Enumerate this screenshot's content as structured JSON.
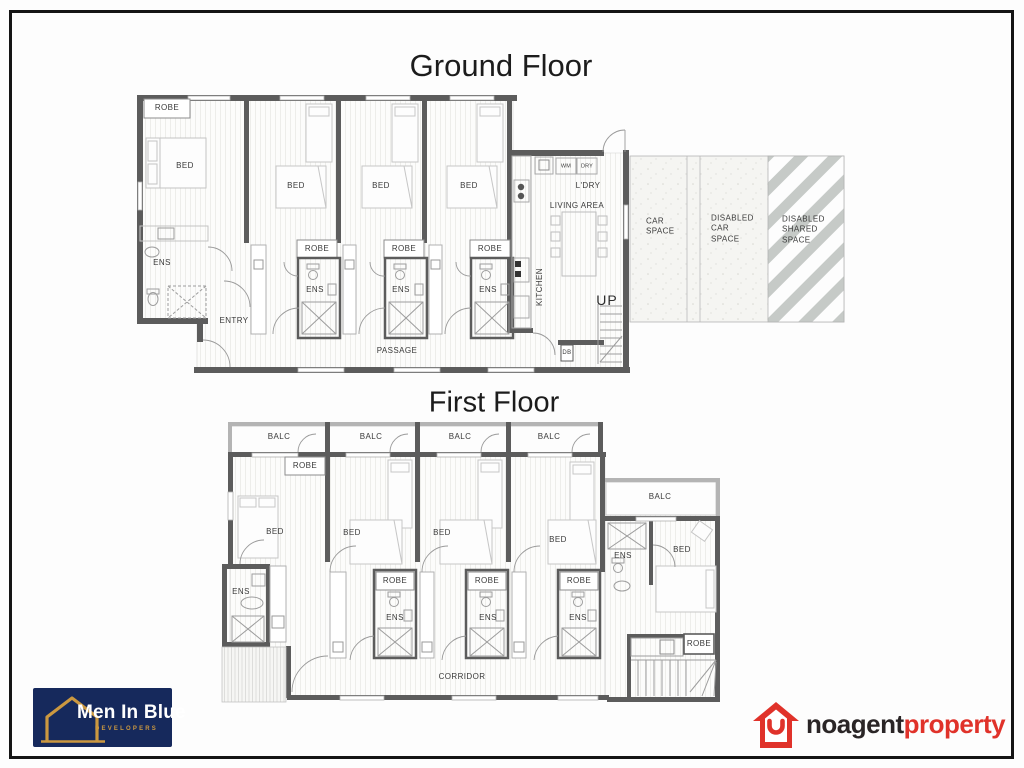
{
  "titles": {
    "ground": "Ground Floor",
    "first": "First Floor"
  },
  "labels": {
    "robe": "ROBE",
    "bed": "BED",
    "ens": "ENS",
    "balc": "BALC",
    "entry": "ENTRY",
    "passage": "PASSAGE",
    "corridor": "CORRIDOR",
    "kitchen": "KITCHEN",
    "laundry": "L'DRY",
    "wm": "WM",
    "dry": "DRY",
    "living_area": "LIVING AREA",
    "up": "UP",
    "db": "DB",
    "car_space": "CAR\nSPACE",
    "disabled_car_space": "DISABLED\nCAR\nSPACE",
    "disabled_shared_space": "DISABLED\nSHARED\nSPACE"
  },
  "logos": {
    "men_in_blue": {
      "name": "Men In Blue",
      "tagline": "DEVELOPERS",
      "bg_color": "#16295c",
      "accent_color": "#cb9840"
    },
    "noagent": {
      "word_dark": "noagent",
      "word_red": "property",
      "red": "#e0322a",
      "dark": "#2a2526"
    }
  }
}
